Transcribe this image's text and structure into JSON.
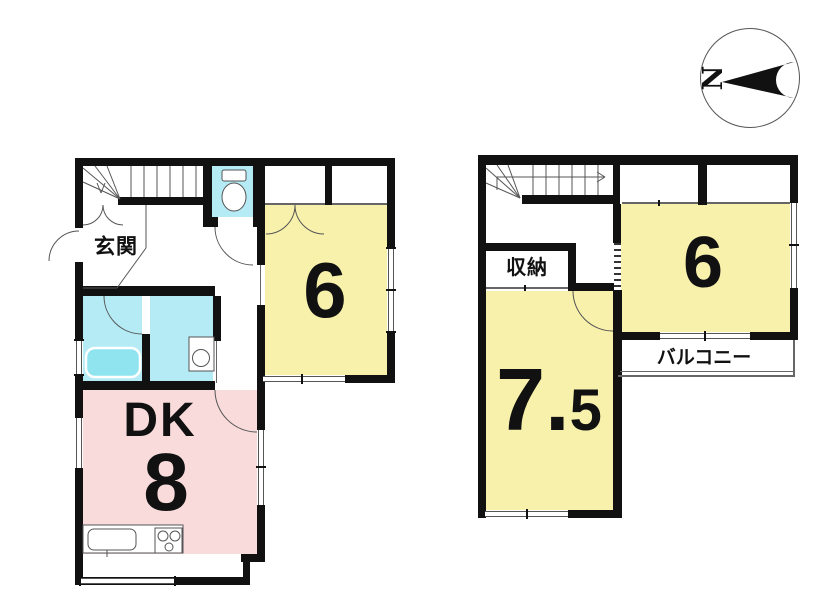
{
  "compass": {
    "north": "N"
  },
  "floor1": {
    "rooms": {
      "genkan": {
        "label": "玄関"
      },
      "washitsu6": {
        "label": "6"
      },
      "dk": {
        "label": "DK",
        "area": "8"
      }
    }
  },
  "floor2": {
    "rooms": {
      "storage": {
        "label": "収納"
      },
      "washitsu6": {
        "label": "6"
      },
      "room75": {
        "label": "7.5"
      },
      "balcony": {
        "label": "バルコニー"
      }
    }
  },
  "colors": {
    "wall": "#111111",
    "tatami_yellow": "#F8F1AC",
    "dk_pink": "#F8DBDA",
    "wet_area_cyan": "#B5EBF5",
    "bathtub_cyan": "#8FE4F0",
    "line_gray": "#666666"
  }
}
